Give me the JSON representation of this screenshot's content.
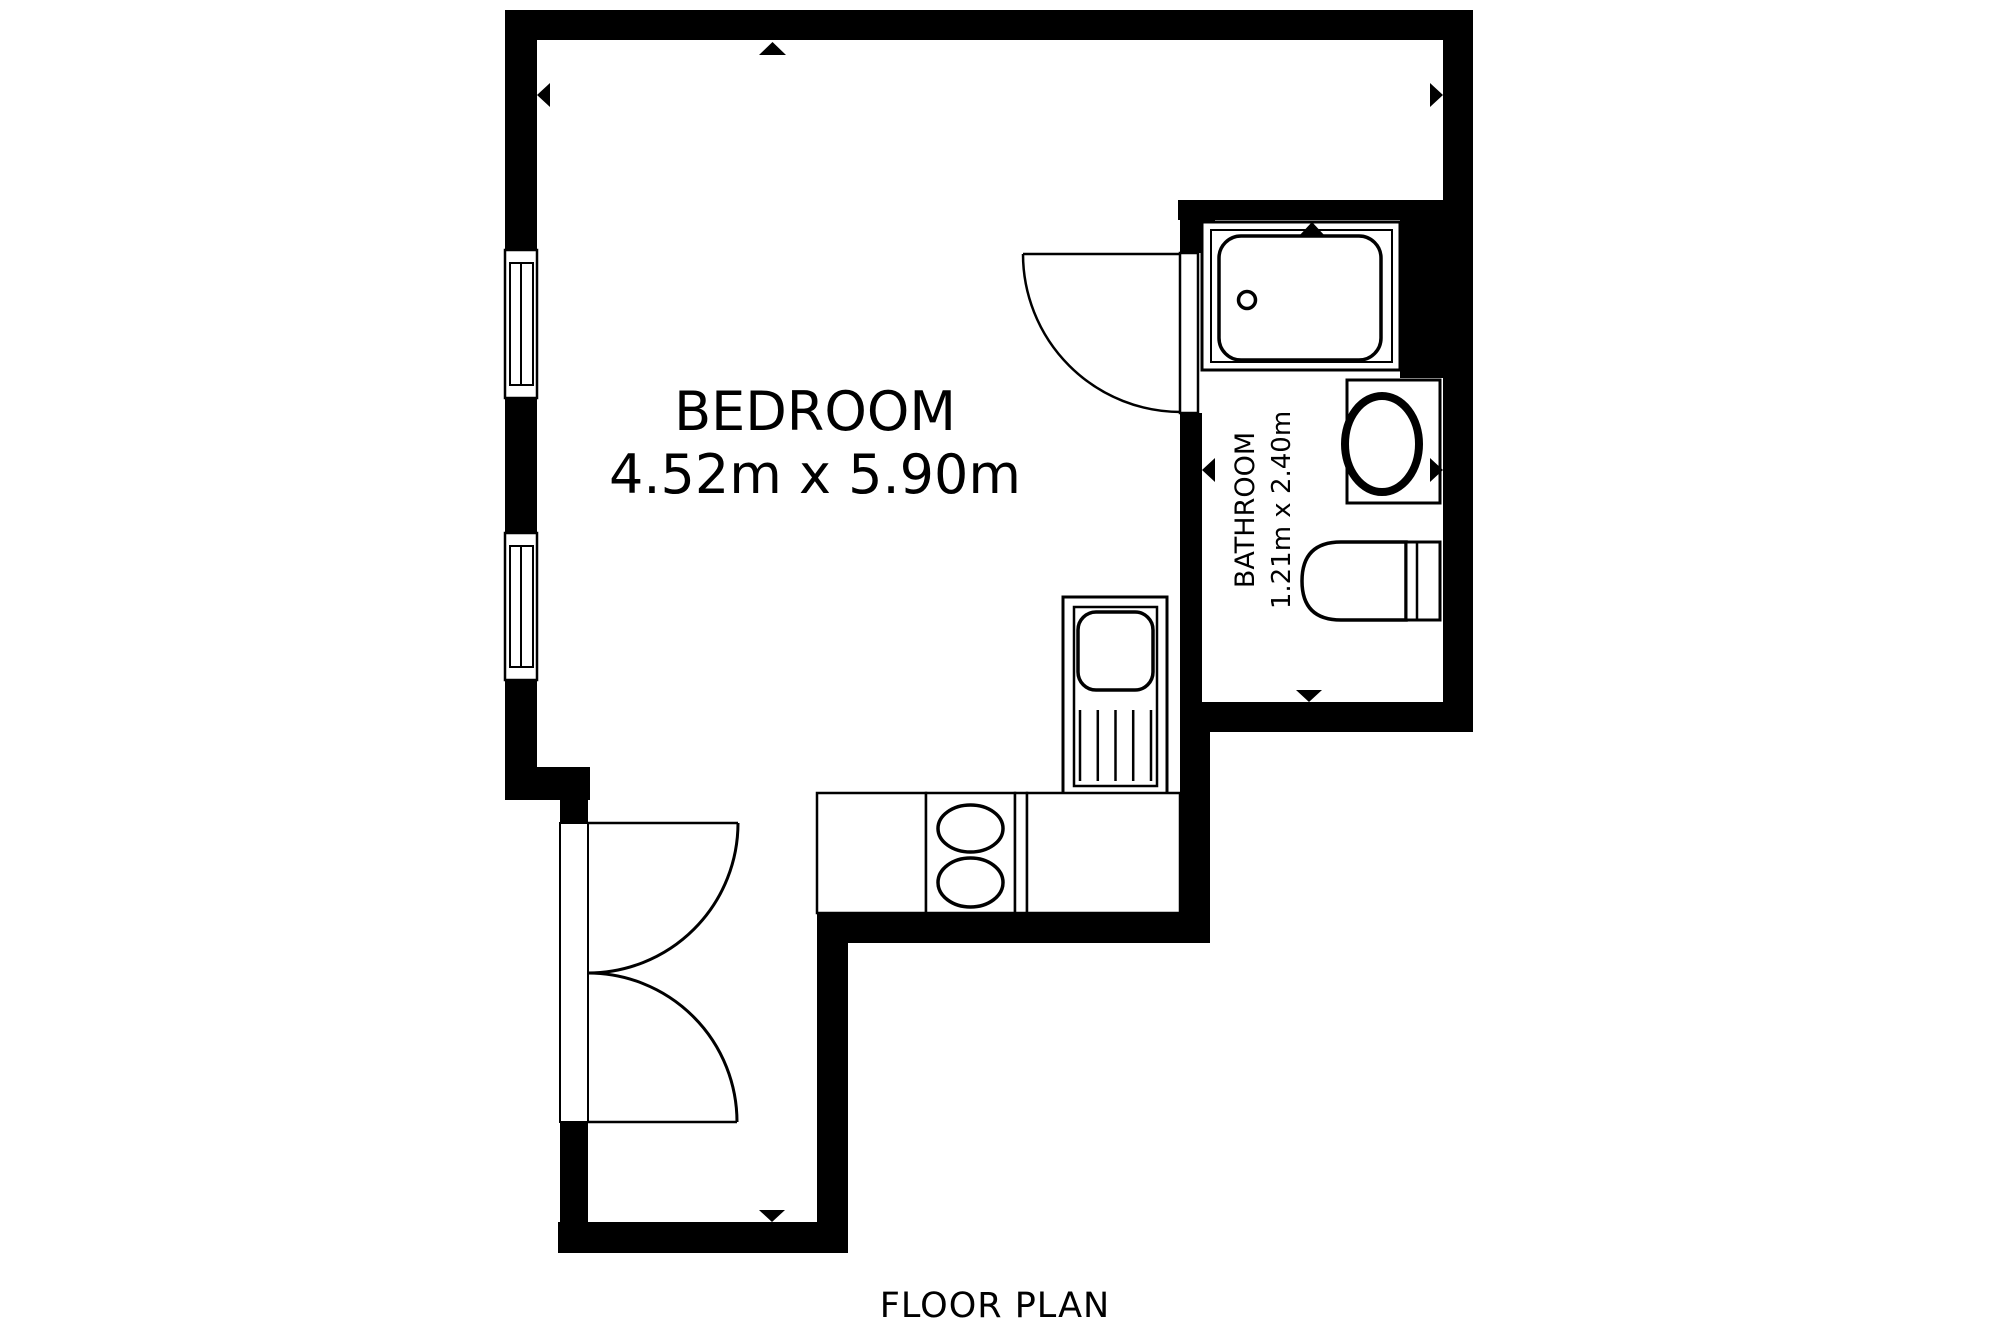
{
  "title": "FLOOR PLAN",
  "colors": {
    "background": "#ffffff",
    "wall": "#000000",
    "line": "#000000",
    "text": "#000000"
  },
  "rooms": {
    "bedroom": {
      "label": "BEDROOM",
      "dimensions": "4.52m x 5.90m"
    },
    "bathroom": {
      "label": "BATHROOM",
      "dimensions": "1.21m x 2.40m"
    }
  },
  "footer": {
    "label": "FLOOR PLAN"
  },
  "fixtures": {
    "bathroom": [
      "shower",
      "washbasin",
      "toilet"
    ],
    "kitchen": [
      "sink-drainer-unit",
      "hob-two-burners",
      "worktop"
    ],
    "doors": [
      "bathroom-single-door",
      "entry-double-door"
    ],
    "windows": [
      "left-wall-window-upper",
      "left-wall-window-lower"
    ],
    "markers": [
      "up-arrow-top-wall",
      "left-arrow-left-wall",
      "right-arrow-right-wall",
      "up-arrow-shower",
      "left-arrow-bathroom",
      "right-arrow-bathroom",
      "down-arrow-bathroom",
      "down-arrow-hall"
    ]
  }
}
